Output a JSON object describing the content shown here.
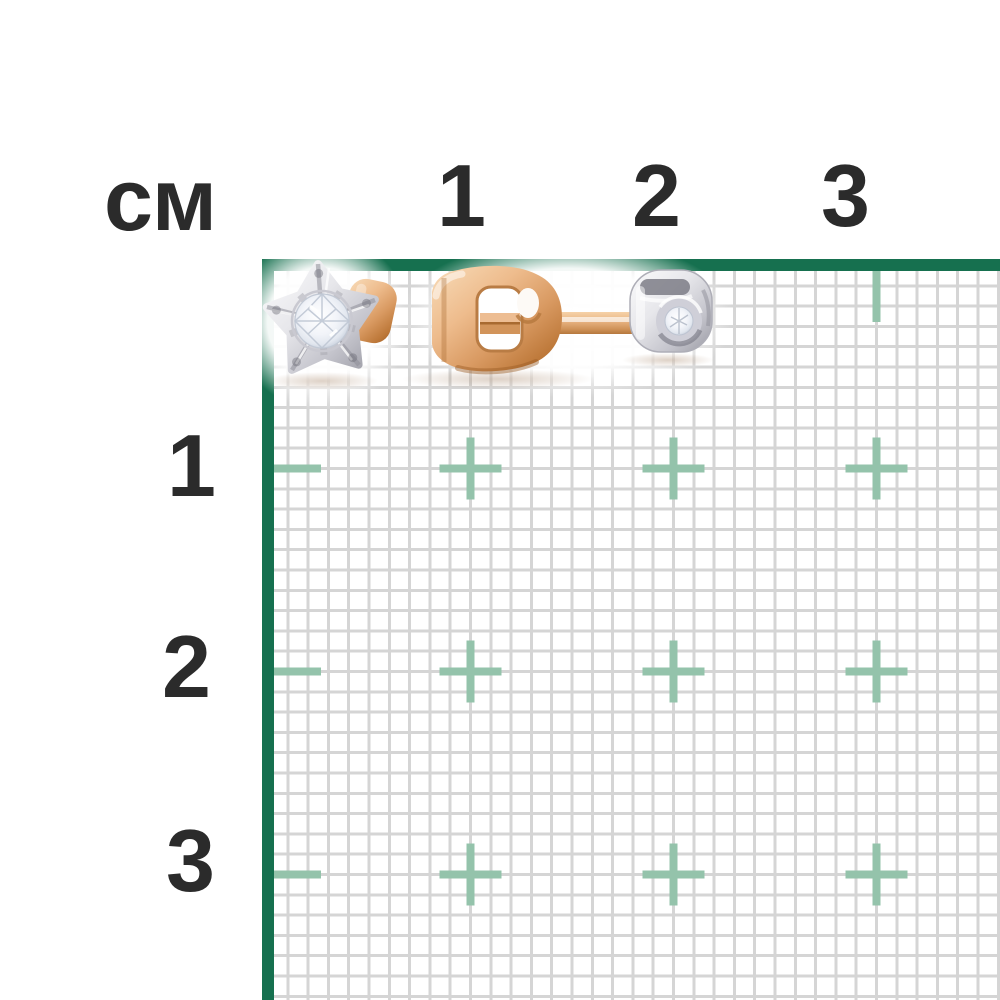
{
  "page": {
    "background_color": "#ffffff",
    "description": "jewelry product size chart: diamond stud earring shown on centimeter grid"
  },
  "ruler": {
    "unit_label": "см",
    "top_labels": [
      "1",
      "2",
      "3"
    ],
    "left_labels": [
      "1",
      "2",
      "3"
    ],
    "text_color": "#2b2b2b",
    "border_color": "#16704f",
    "mark_color": "#94c3ab",
    "grid_line_color": "#d5d5d5"
  },
  "jewelry": {
    "description": "rose gold diamond stud earring, front view and side view with butterfly clutch back",
    "colors": {
      "rose_gold_highlight": "#f8dcb9",
      "rose_gold_mid": "#d99a62",
      "rose_gold_shadow": "#a05f27",
      "white_gold_highlight": "#fbfbfc",
      "white_gold_shadow": "#9a9aa3",
      "diamond": "#eef1f6"
    }
  }
}
